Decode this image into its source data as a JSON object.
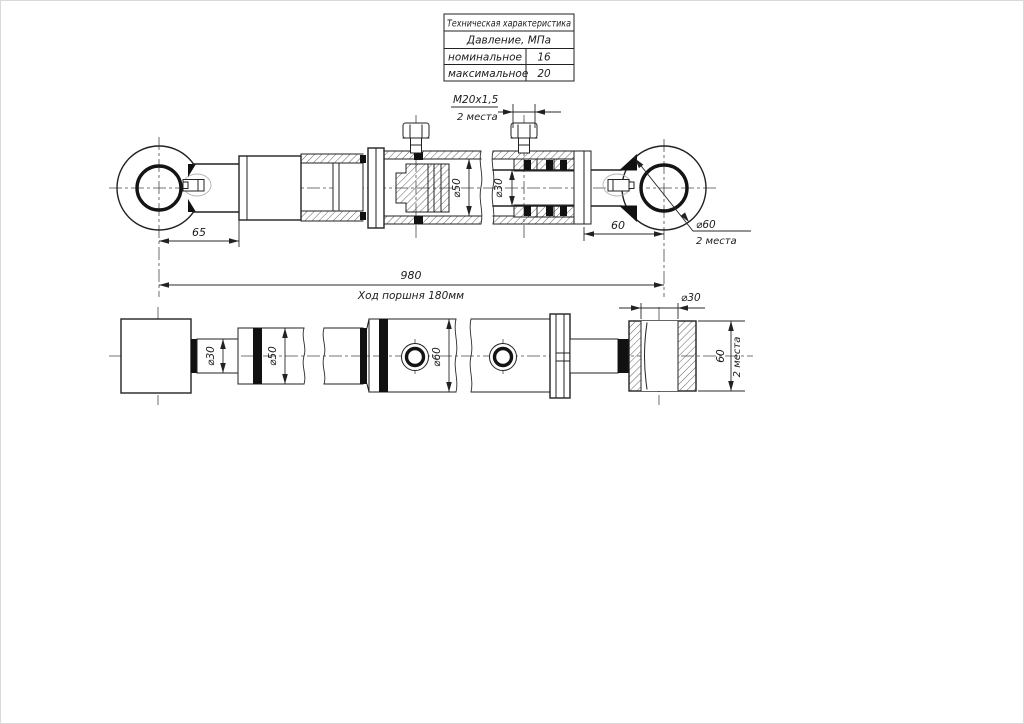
{
  "spec_table": {
    "title": "Техническая характеристика",
    "subtitle": "Давление, МПа",
    "rows": [
      {
        "label": "номинальное",
        "value": "16"
      },
      {
        "label": "максимальное",
        "value": "20"
      }
    ]
  },
  "front_view": {
    "thread_label": "М20х1,5",
    "thread_places": "2 места",
    "dim_left_offset": "65",
    "dim_bore": "⌀50",
    "dim_rod": "⌀30",
    "dim_right_offset": "60",
    "eye_diameter": "⌀60",
    "eye_places": "2 места",
    "overall_length": "980",
    "stroke_note": "Ход поршня 180мм"
  },
  "plan_view": {
    "dim_rod": "⌀30",
    "dim_cylinder": "⌀50",
    "dim_barrel": "⌀60",
    "dim_eye_bore": "⌀30",
    "dim_eye_width": "60",
    "eye_places": "2 места"
  }
}
